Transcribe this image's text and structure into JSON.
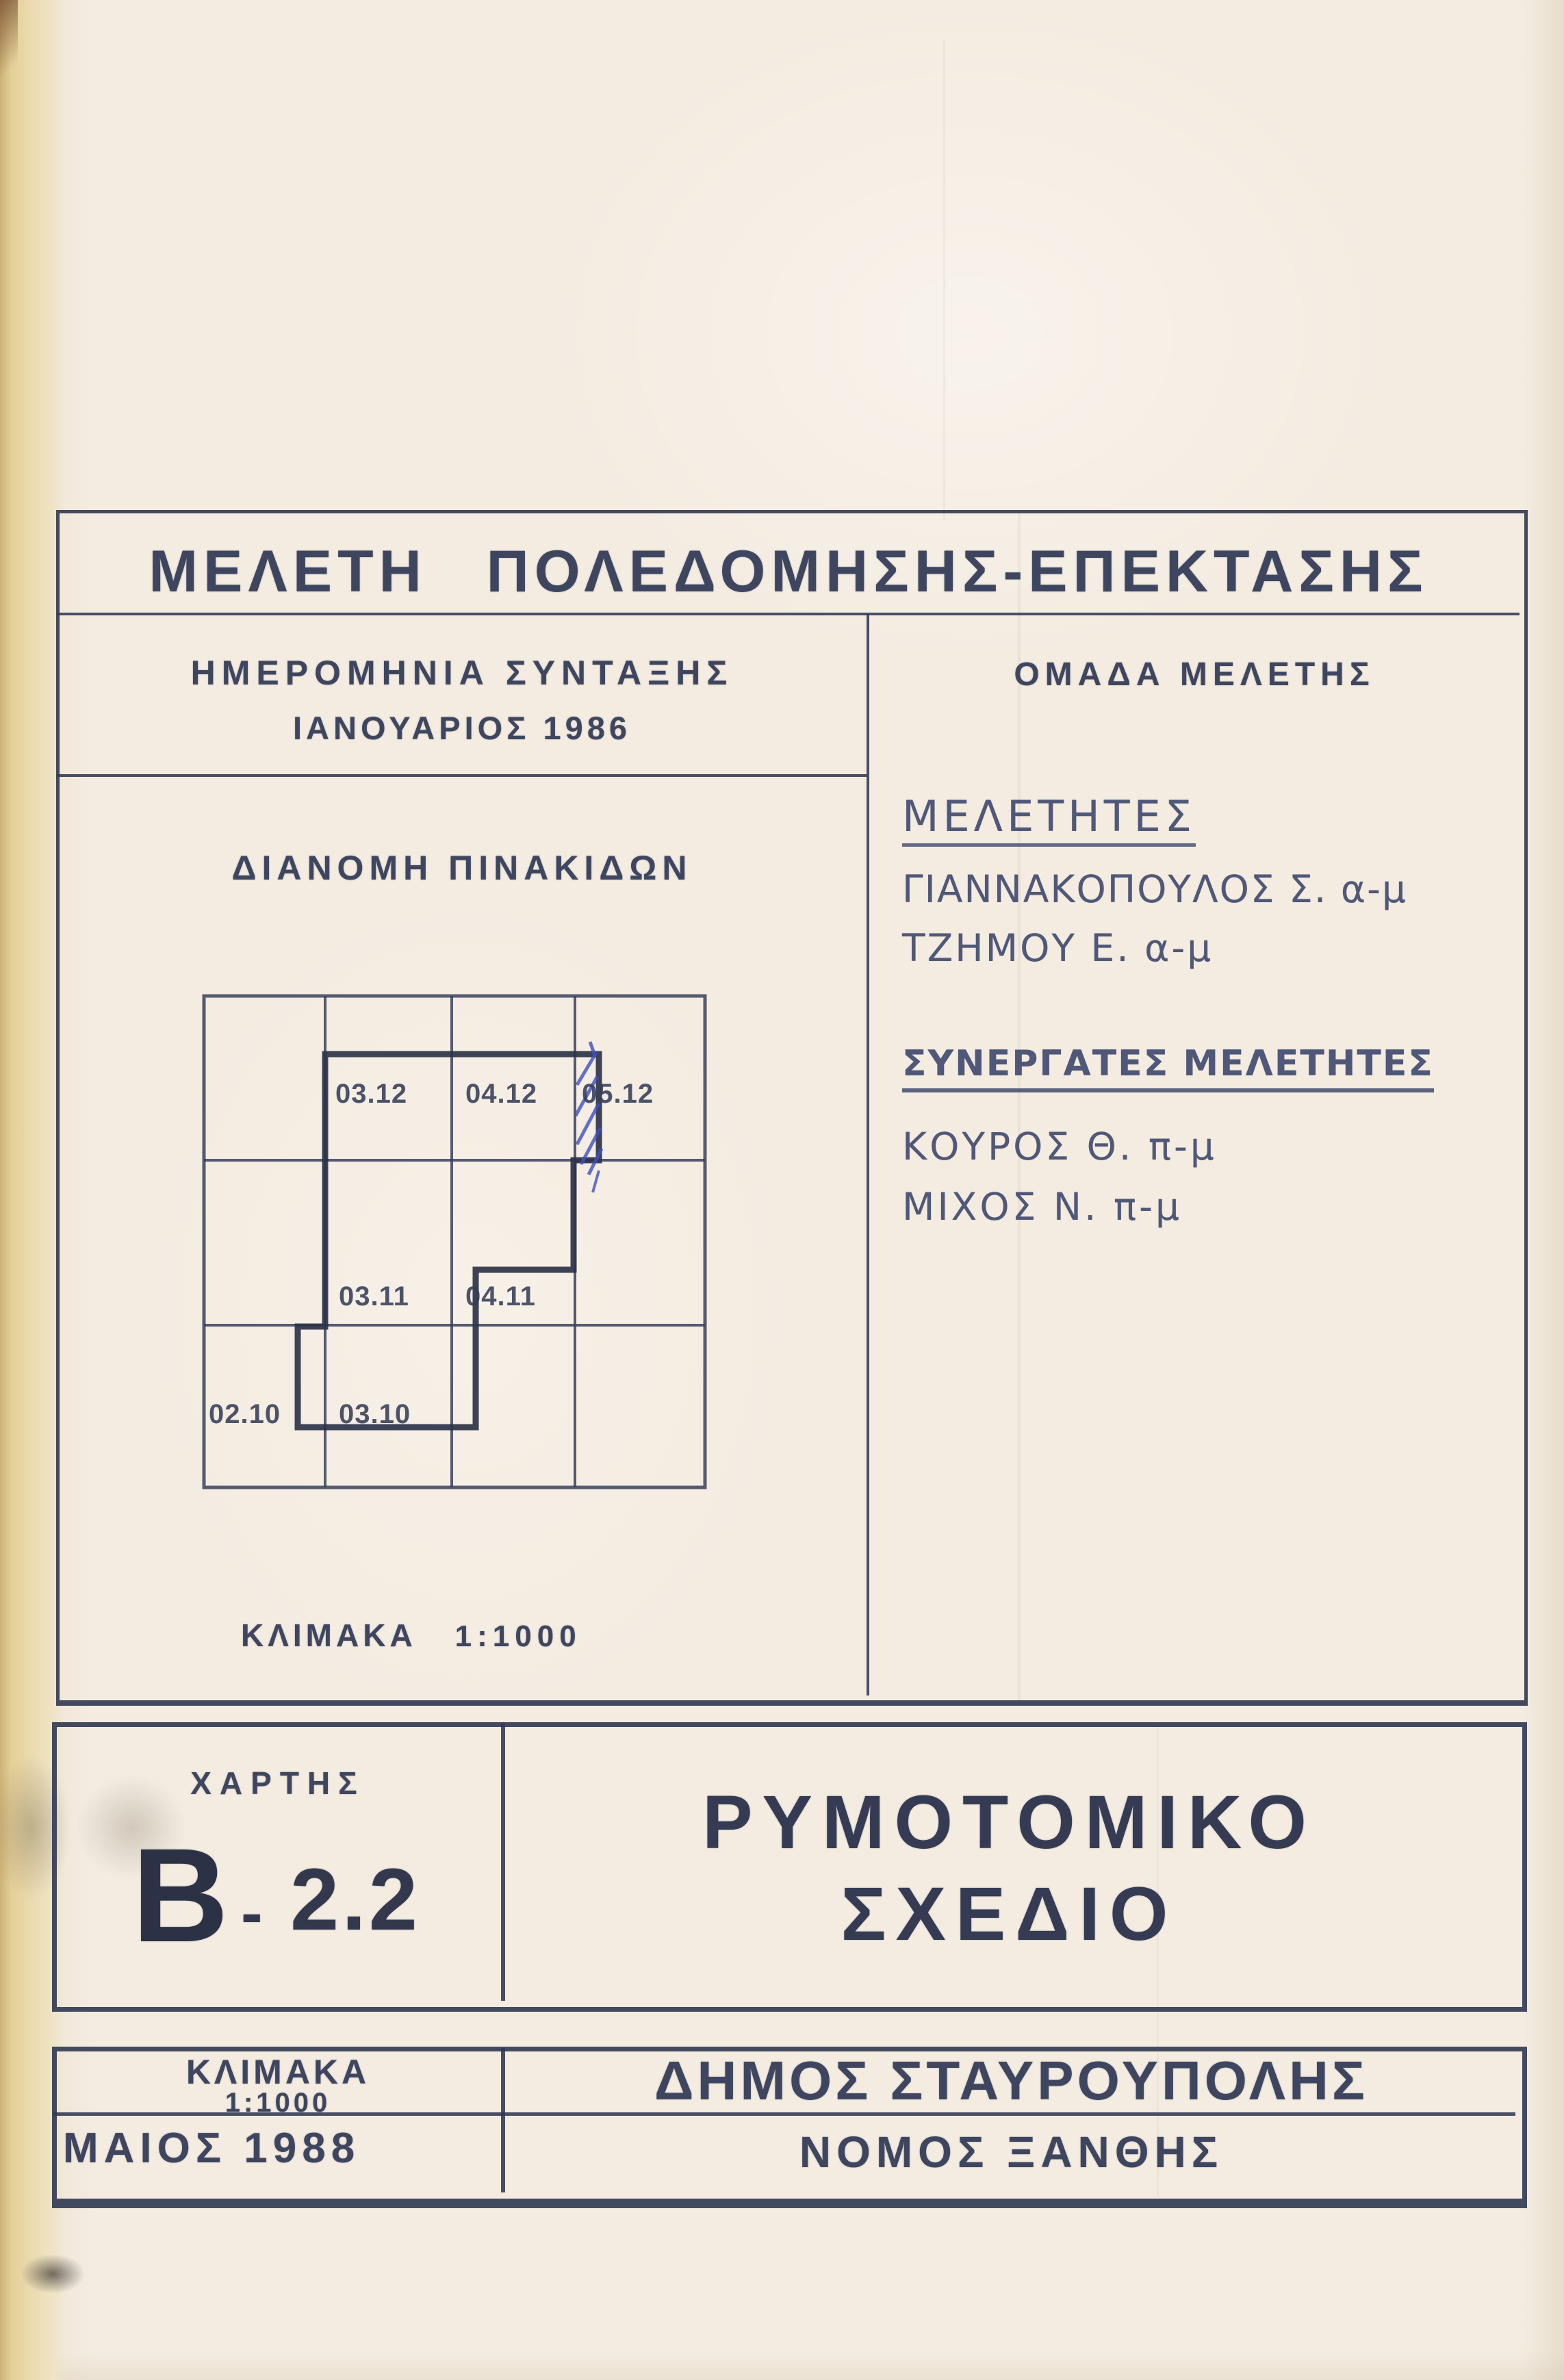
{
  "title": "ΜΕΛΕΤΗ ΠΟΛΕΔΟΜΗΣΗΣ-ΕΠΕΚΤΑΣΗΣ",
  "left": {
    "date_heading": "ΗΜΕΡΟΜΗΝΙΑ ΣΥΝΤΑΞΗΣ",
    "date_value": "ΙΑΝΟΥΑΡΙΟΣ 1986",
    "diagram_heading": "ΔΙΑΝΟΜΗ ΠΙΝΑΚΙΔΩΝ",
    "scale_label": "ΚΛΙΜΑΚΑ",
    "scale_value": "1:1000"
  },
  "right": {
    "team_heading": "ΟΜΑΔΑ ΜΕΛΕΤΗΣ",
    "researchers_heading": "ΜΕΛΕΤΗΤΕΣ",
    "researchers": [
      "ΓΙΑΝΝΑΚΟΠΟΥΛΟΣ Σ. α-μ",
      "ΤΖΗΜΟΥ Ε. α-μ"
    ],
    "collaborators_heading": "ΣΥΝΕΡΓΑΤΕΣ ΜΕΛΕΤΗΤΕΣ",
    "collaborators": [
      "ΚΟΥΡΟΣ Θ. π-μ",
      "ΜΙΧΟΣ Ν. π-μ"
    ]
  },
  "diagram": {
    "tiles": [
      "03.12",
      "04.12",
      "05.12",
      "03.11",
      "04.11",
      "02.10",
      "03.10"
    ],
    "hatched_tile": "05.12",
    "grid_columns": 4,
    "grid_rows": 3
  },
  "map_block": {
    "label": "ΧΑΡΤΗΣ",
    "code_letter": "Β",
    "code_dash": "-",
    "code_number": "2.2",
    "title_line1": "ΡΥΜΟΤΟΜΙΚΟ",
    "title_line2": "ΣΧΕΔΙΟ"
  },
  "footer": {
    "scale_label": "ΚΛΙΜΑΚΑ",
    "scale_value": "1:1000",
    "municipality": "ΔΗΜΟΣ ΣΤΑΥΡΟΥΠΟΛΗΣ",
    "date": "ΜΑΙΟΣ 1988",
    "prefecture": "ΝΟΜΟΣ ΞΑΝΘΗΣ"
  },
  "colors": {
    "ink": "#3b4258",
    "ink_strong": "#2c3349",
    "pen_blue": "#3f50c0",
    "paper": "#f4ece1",
    "paper_edge": "#e8d6a2"
  }
}
